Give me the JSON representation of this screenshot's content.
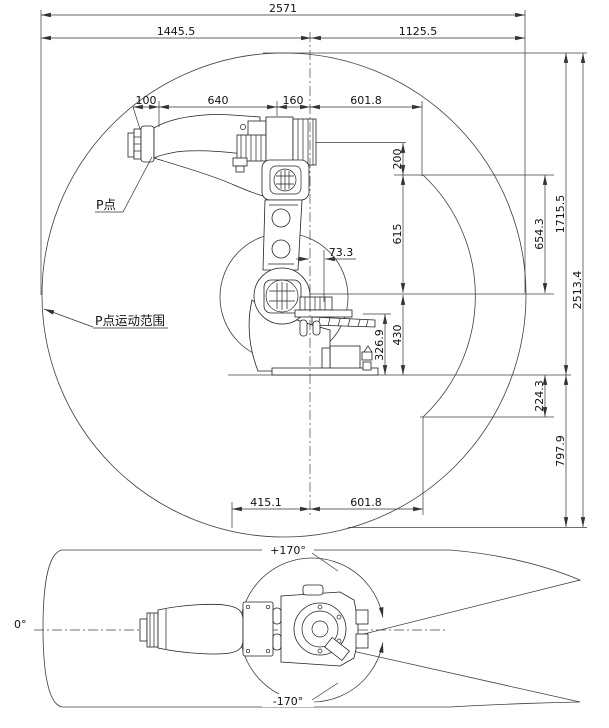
{
  "side_view": {
    "labels": {
      "p_point": "P点",
      "p_range": "P点运动范围"
    },
    "dims": {
      "total_width": "2571",
      "reach_left": "1445.5",
      "reach_right": "1125.5",
      "flange_to_p": "100",
      "forearm_length": "640",
      "elbow_offset": "160",
      "upper_right_reach": "601.8",
      "axis_offset": "73.3",
      "p_to_elbow": "200",
      "elbow_to_shoulder": "615",
      "inner_arc_height": "654.3",
      "height_above_ground": "1715.5",
      "total_height": "2513.4",
      "shoulder_to_ground": "430",
      "base_height": "326.9",
      "below_ground": "224.3",
      "lower_height": "797.9",
      "lower_left_reach": "415.1",
      "lower_right_reach": "601.8"
    }
  },
  "top_view": {
    "labels": {
      "angle_plus": "+170°",
      "angle_zero": "0°",
      "angle_minus": "-170°"
    }
  }
}
